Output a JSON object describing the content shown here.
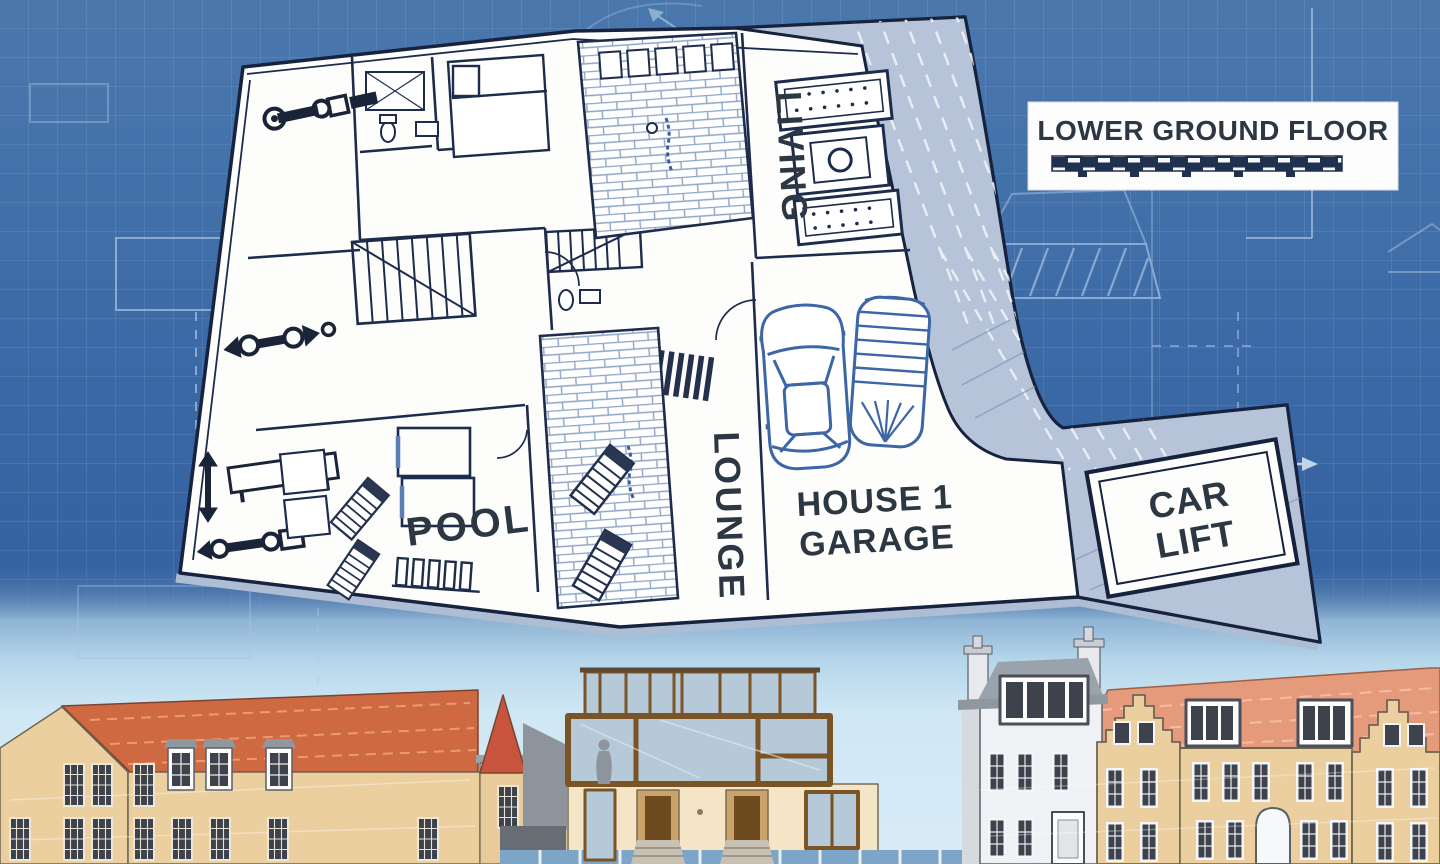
{
  "legend": {
    "title": "LOWER GROUND FLOOR"
  },
  "plan": {
    "room_labels": {
      "living": "LIVING",
      "pool": "POOL",
      "lounge": "LOUNGE"
    },
    "garage": {
      "line1": "HOUSE 1",
      "line2": "GARAGE"
    },
    "car_lift": {
      "line1": "CAR",
      "line2": "LIFT"
    }
  },
  "colors": {
    "blueprint_blue": "#3e6ca7",
    "plan_line": "#17233e",
    "plan_fill": "#fdfdfb",
    "ramp_grey": "#b6c3d8",
    "label_text": "#2c3744",
    "legend_bg": "#fcfdfc",
    "scale_bar_navy": "#20304f",
    "brick_line": "#8ea6c6",
    "car_sketch_blue": "#3c66a6",
    "sky": "#cfe7f4",
    "roof_orange": "#cf6941",
    "roof_salmon": "#e59a7b",
    "wall_tan": "#ebcf9e",
    "wall_cream": "#f3e5c6",
    "wall_white": "#eff1f4",
    "frame_bronze": "#7b5426",
    "glass_blue": "#b5c9d8",
    "window_dark": "#3d424c"
  }
}
